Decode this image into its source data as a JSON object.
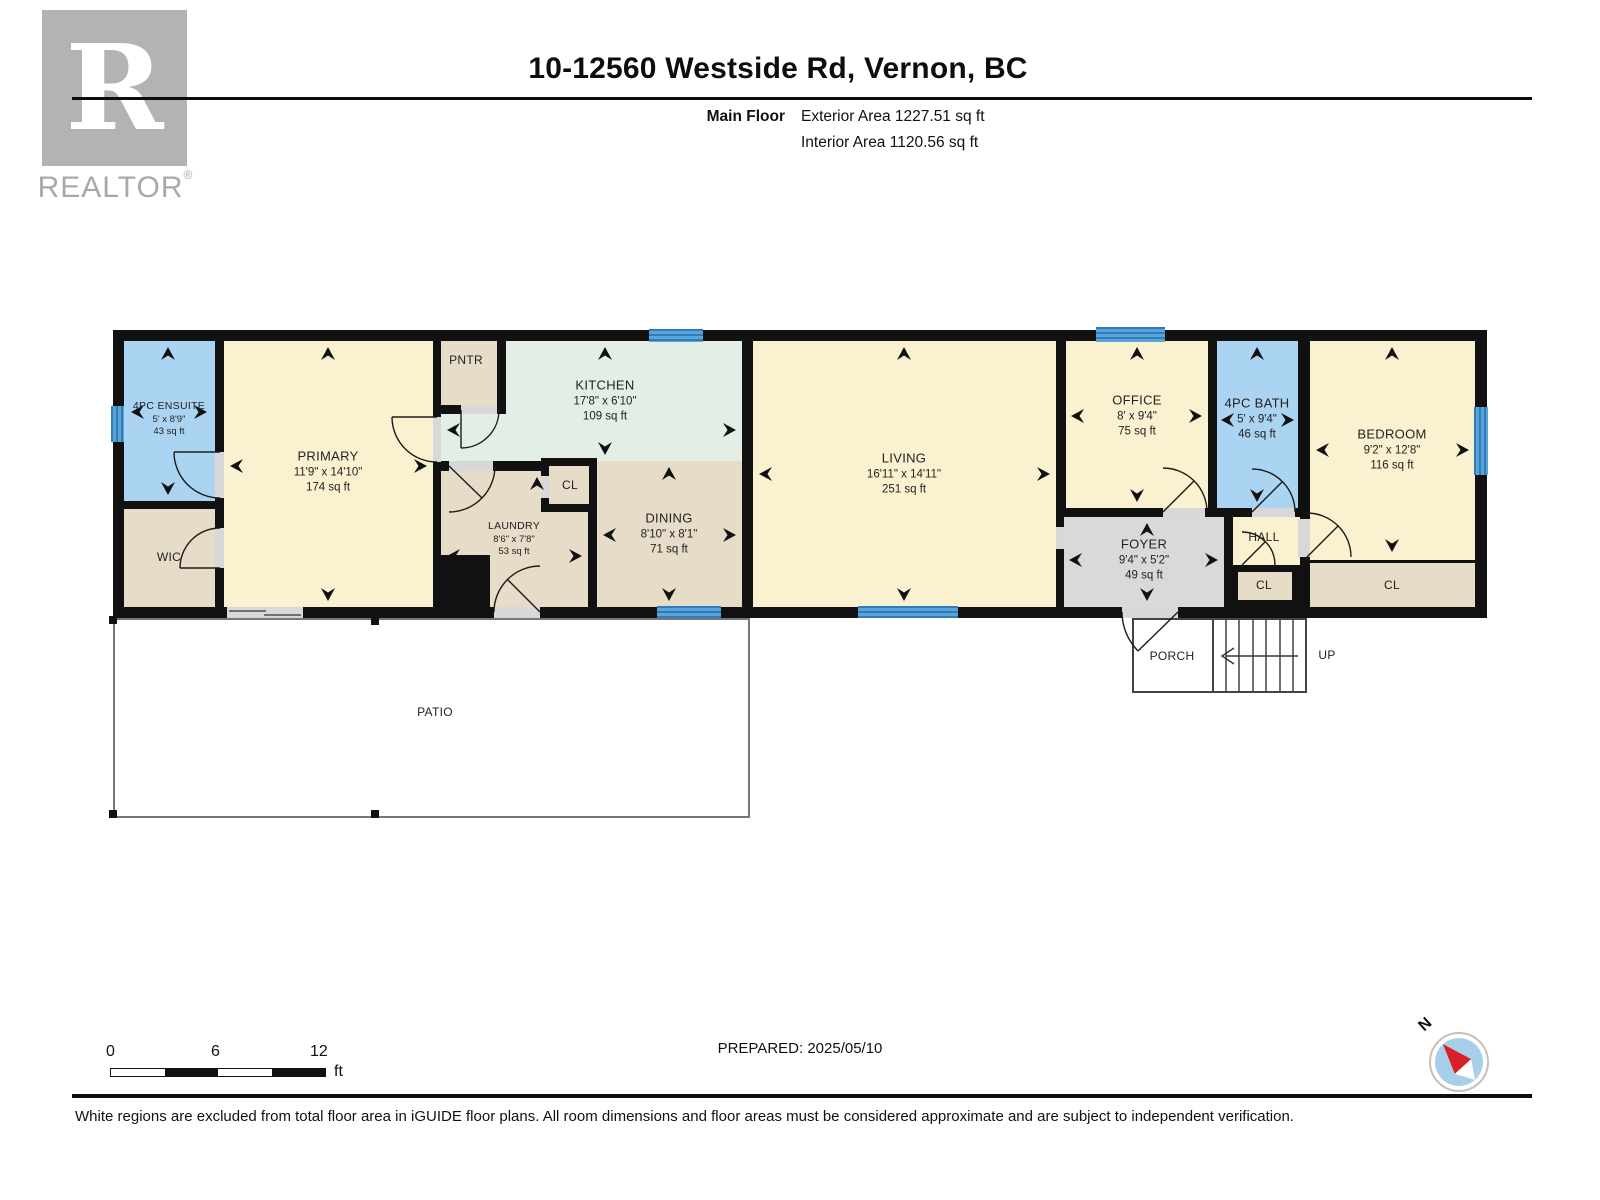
{
  "branding": {
    "logo_letter": "R",
    "logo_text": "REALTOR",
    "logo_reg": "®"
  },
  "header": {
    "address": "10-12560 Westside Rd, Vernon, BC",
    "floor_label": "Main Floor",
    "exterior_area": "Exterior Area 1227.51 sq ft",
    "interior_area": "Interior Area 1120.56 sq ft"
  },
  "rooms": [
    {
      "id": "ensuite",
      "name": "4PC ENSUITE",
      "dims": "5' x 8'9\"",
      "area": "43 sq ft"
    },
    {
      "id": "wic",
      "name": "WIC"
    },
    {
      "id": "primary",
      "name": "PRIMARY",
      "dims": "11'9\" x 14'10\"",
      "area": "174 sq ft"
    },
    {
      "id": "pntr",
      "name": "PNTR"
    },
    {
      "id": "kitchen",
      "name": "KITCHEN",
      "dims": "17'8\" x 6'10\"",
      "area": "109 sq ft"
    },
    {
      "id": "cl-laundry",
      "name": "CL"
    },
    {
      "id": "laundry",
      "name": "LAUNDRY",
      "dims": "8'6\" x 7'8\"",
      "area": "53 sq ft"
    },
    {
      "id": "dining",
      "name": "DINING",
      "dims": "8'10\" x 8'1\"",
      "area": "71 sq ft"
    },
    {
      "id": "living",
      "name": "LIVING",
      "dims": "16'11\" x 14'11\"",
      "area": "251 sq ft"
    },
    {
      "id": "office",
      "name": "OFFICE",
      "dims": "8' x 9'4\"",
      "area": "75 sq ft"
    },
    {
      "id": "bath",
      "name": "4PC BATH",
      "dims": "5' x 9'4\"",
      "area": "46 sq ft"
    },
    {
      "id": "bedroom",
      "name": "BEDROOM",
      "dims": "9'2\" x 12'8\"",
      "area": "116 sq ft"
    },
    {
      "id": "foyer",
      "name": "FOYER",
      "dims": "9'4\" x 5'2\"",
      "area": "49 sq ft"
    },
    {
      "id": "hall",
      "name": "HALL"
    },
    {
      "id": "cl-hall",
      "name": "CL"
    },
    {
      "id": "cl-bedroom",
      "name": "CL"
    },
    {
      "id": "porch",
      "name": "PORCH"
    },
    {
      "id": "up",
      "name": "UP"
    },
    {
      "id": "patio",
      "name": "PATIO"
    }
  ],
  "scale_bar": {
    "labels": [
      "0",
      "6",
      "12"
    ],
    "unit": "ft"
  },
  "compass": {
    "label": "N"
  },
  "footer": {
    "prepared": "PREPARED: 2025/05/10",
    "disclaimer": "White regions are excluded from total floor area in iGUIDE floor plans. All room dimensions and floor areas must be considered approximate and are subject to independent verification."
  },
  "colors": {
    "wall": "#111111",
    "room_cream": "#faf1d0",
    "room_tan": "#e6dcc8",
    "room_mint": "#e3efe6",
    "room_blue": "#abd4f2",
    "room_gray": "#d9d9d9",
    "window_blue": "#5aa4da",
    "compass_needle": "#d61f26",
    "logo_gray": "#b3b3b3"
  }
}
